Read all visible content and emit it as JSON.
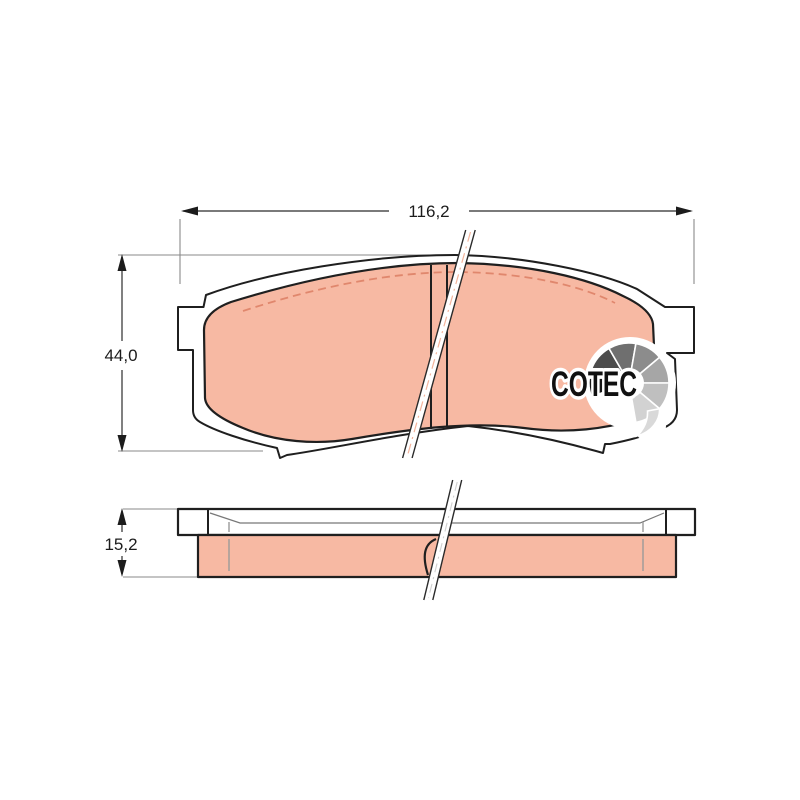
{
  "drawing": {
    "dimensions": {
      "width": "116,2",
      "height": "44,0",
      "thickness": "15,2"
    },
    "logo": {
      "text": "COTEC",
      "fan_colors": [
        "#161616",
        "#4c4c4c",
        "#6f6f6f",
        "#8c8c8c",
        "#a6a6a6",
        "#bfbfbf",
        "#d2d2d2",
        "#d9d9d9"
      ]
    },
    "colors": {
      "background": "#ffffff",
      "outline": "#1f1f1f",
      "plate_fill": "#ffffff",
      "pad_fill": "#f7b9a3",
      "chamfer_dash": "#e0876d",
      "dimension_line": "#2a2a2a",
      "extension_line": "#8a8a8a",
      "break_centerline_front": "#f3b49c",
      "break_centerline_side": "#cfcfcf"
    }
  }
}
